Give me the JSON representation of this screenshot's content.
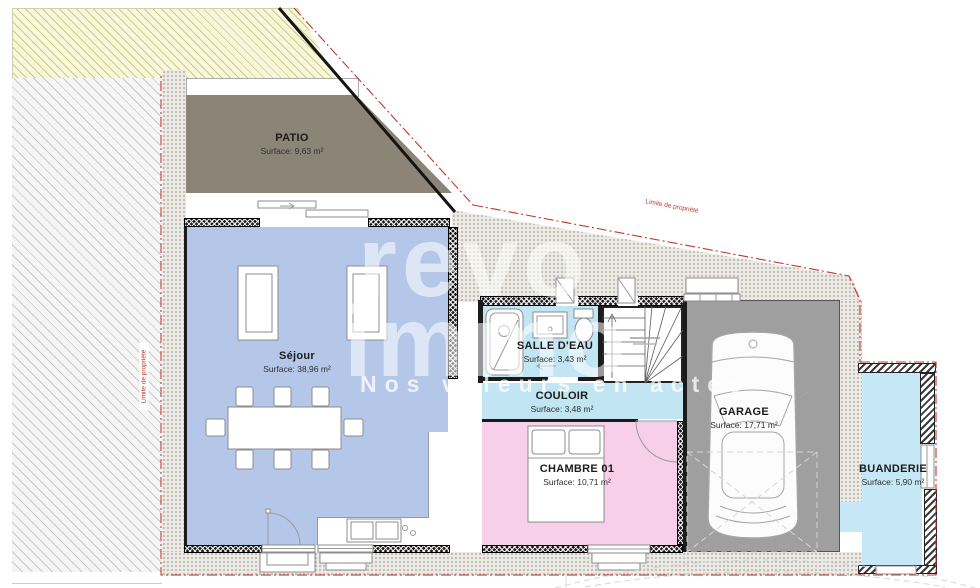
{
  "plan": {
    "watermark": {
      "line1": "revo",
      "line2": "immo",
      "tagline": "Nos valeurs en actes"
    },
    "boundary": {
      "label": "Limite de propriété",
      "color": "#c0392b"
    },
    "rooms": [
      {
        "id": "patio",
        "name": "PATIO",
        "surface": "Surface: 9,63 m²",
        "color": "#8d8478"
      },
      {
        "id": "sejour",
        "name": "Séjour",
        "surface": "Surface: 38,96 m²",
        "color": "#b4c7e9"
      },
      {
        "id": "salle-deau",
        "name": "SALLE D'EAU",
        "surface": "Surface: 3,43 m²",
        "color": "#c2e5f3"
      },
      {
        "id": "couloir",
        "name": "COULOIR",
        "surface": "Surface: 3,48 m²",
        "color": "#c2e5f3"
      },
      {
        "id": "chambre-01",
        "name": "CHAMBRE 01",
        "surface": "Surface: 10,71 m²",
        "color": "#f8cfe8"
      },
      {
        "id": "garage",
        "name": "GARAGE",
        "surface": "Surface: 17,71 m²",
        "color": "#9f9f9f"
      },
      {
        "id": "buanderie",
        "name": "BUANDERIE",
        "surface": "Surface: 5,90 m²",
        "color": "#c6e8f6"
      }
    ]
  }
}
